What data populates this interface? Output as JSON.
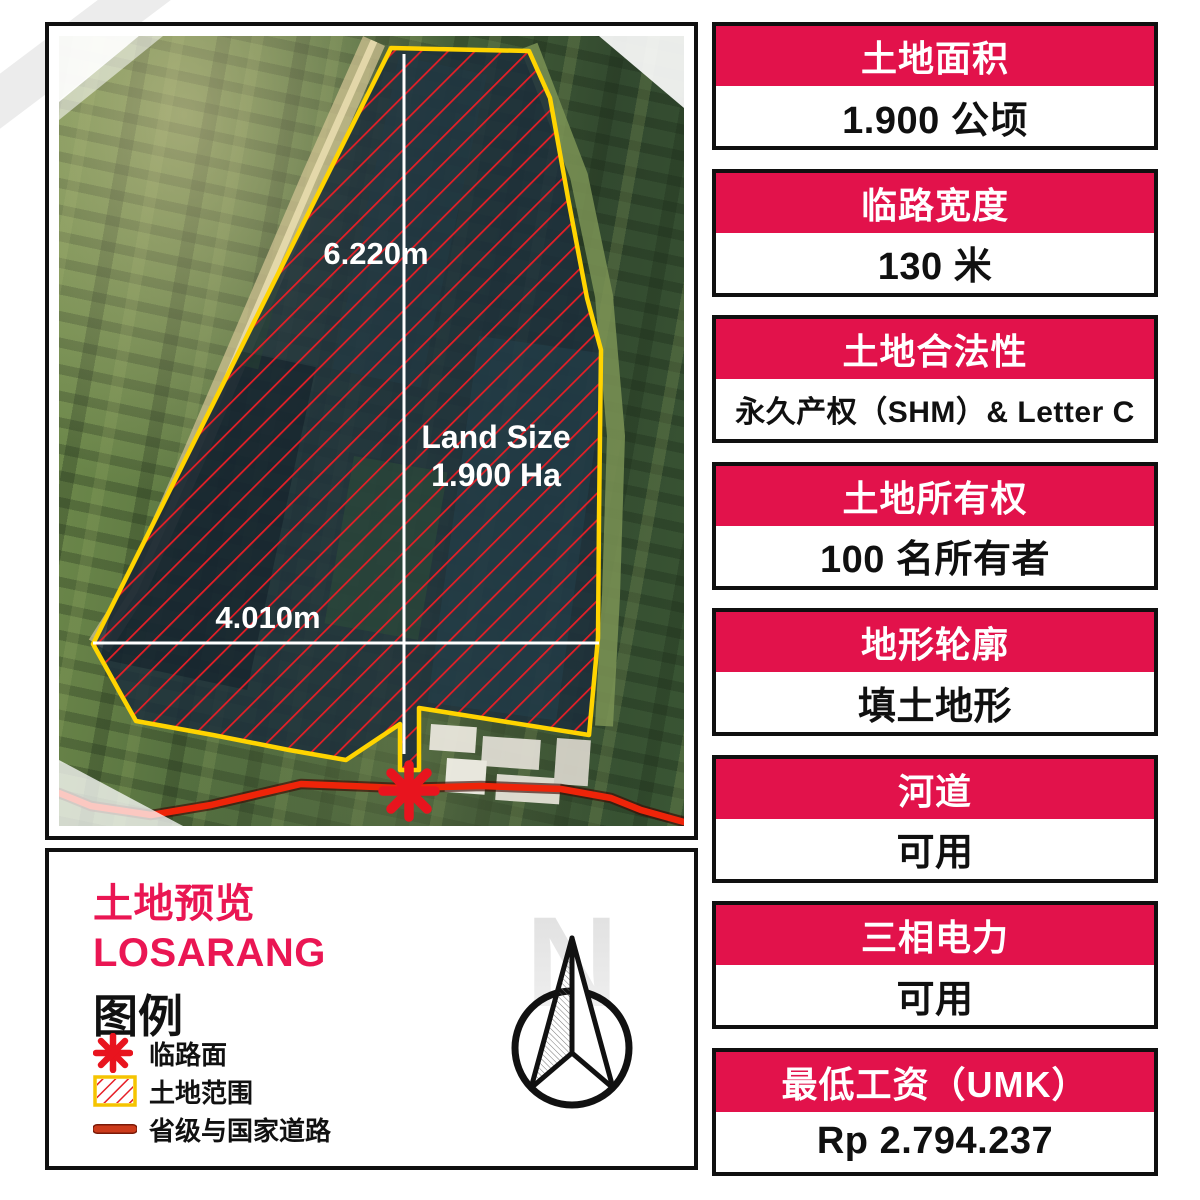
{
  "map": {
    "dim_vertical_label": "6.220m",
    "dim_horizontal_label": "4.010m",
    "land_size_line1": "Land Size",
    "land_size_line2": "1.900 Ha"
  },
  "legend": {
    "title_line1": "土地预览",
    "title_line2": "LOSARANG",
    "heading": "图例",
    "items": [
      {
        "icon": "road-frontage-marker",
        "label": "临路面"
      },
      {
        "icon": "land-extent-swatch",
        "label": "土地范围"
      },
      {
        "icon": "provincial-national-road-line",
        "label": "省级与国家道路"
      }
    ],
    "compass_letter": "N"
  },
  "cards": [
    {
      "header": "土地面积",
      "value": "1.900 公顷"
    },
    {
      "header": "临路宽度",
      "value": "130 米"
    },
    {
      "header": "土地合法性",
      "value": "永久产权（SHM）& Letter C"
    },
    {
      "header": "土地所有权",
      "value": "100 名所有者"
    },
    {
      "header": "地形轮廓",
      "value": "填土地形"
    },
    {
      "header": "河道",
      "value": "可用"
    },
    {
      "header": "三相电力",
      "value": "可用"
    },
    {
      "header": "最低工资（UMK）",
      "value": "Rp 2.794.237"
    }
  ],
  "colors": {
    "card_header_red": "#E2124B",
    "legend_title_pink": "#EA1653",
    "parcel_boundary_yellow": "#FFD400",
    "hatch_red": "#E61F27",
    "road_red": "#EE2409",
    "marker_red": "#E8141E",
    "panel_border_black": "#101010"
  }
}
